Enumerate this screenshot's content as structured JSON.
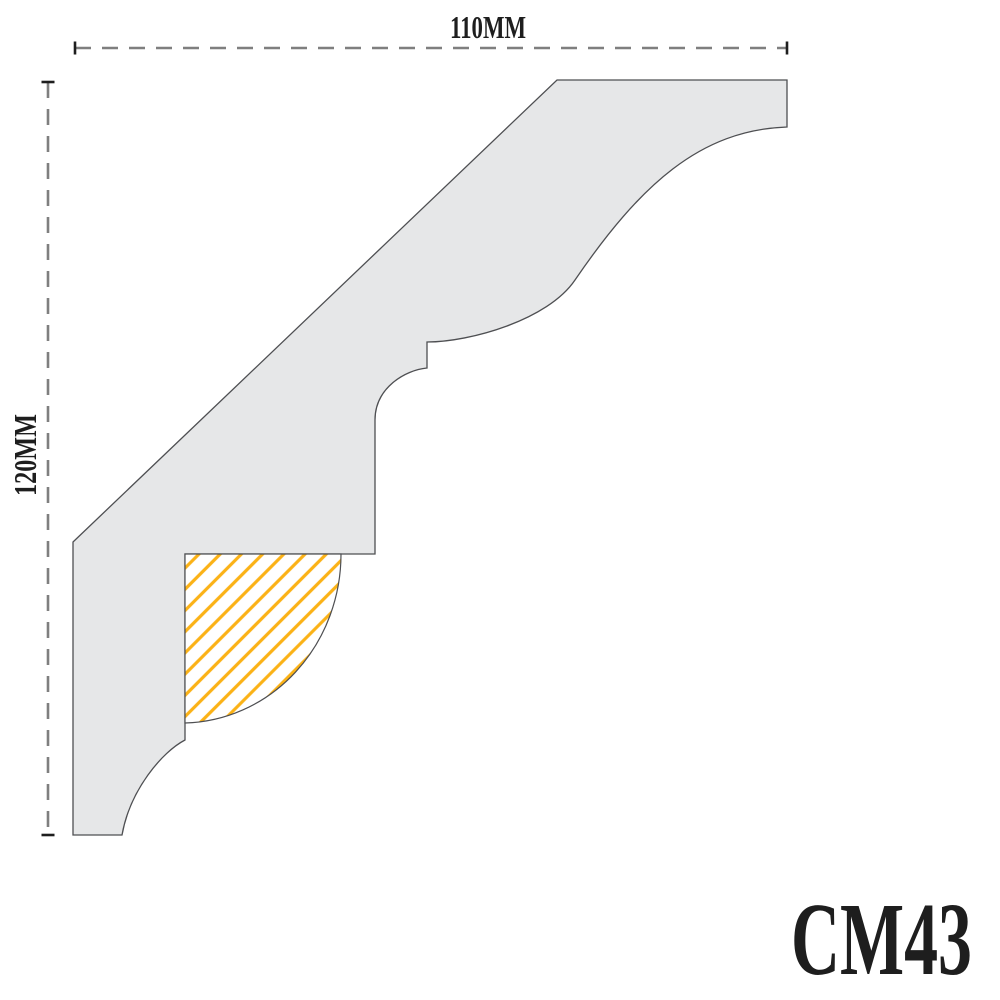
{
  "diagram": {
    "product_code": "CM43",
    "dimensions": {
      "width_label": "110MM",
      "height_label": "120MM",
      "width_mm": 110,
      "height_mm": 120
    },
    "colors": {
      "profile_fill": "#E6E7E8",
      "profile_outline": "#4E4F52",
      "hatch_stroke": "#FBB216",
      "hatch_background": "#FFFFFF",
      "dimension_line": "#7F7F7F",
      "dimension_tick": "#1E1E1E",
      "label_text": "#1E1E1E"
    }
  }
}
